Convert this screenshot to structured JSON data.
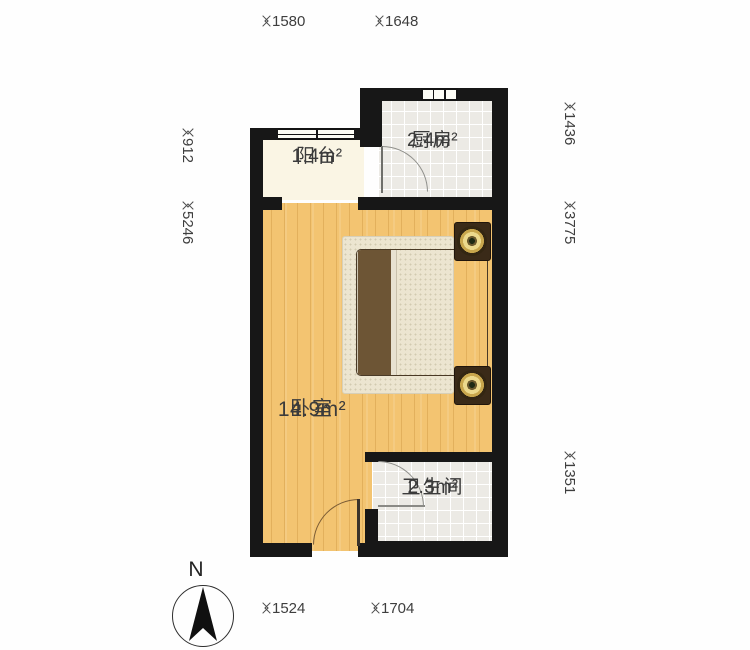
{
  "plan": {
    "rooms": [
      {
        "id": "balcony",
        "name": "阳台",
        "area": "1.4m²"
      },
      {
        "id": "kitchen",
        "name": "厨房",
        "area": "2.4m²"
      },
      {
        "id": "bedroom",
        "name": "卧室",
        "area": "14.9m²"
      },
      {
        "id": "bathroom",
        "name": "卫生间",
        "area": "2.3m²"
      }
    ],
    "dimensions": {
      "top": [
        "1580",
        "1648"
      ],
      "bottom": [
        "1524",
        "1704"
      ],
      "left": [
        "912",
        "5246"
      ],
      "right": [
        "1436",
        "3775",
        "1351"
      ]
    },
    "compass": {
      "label": "N"
    },
    "colors": {
      "wall": "#171717",
      "wood_floor": "#f3c471",
      "tile_floor": "#eceae5",
      "balcony_floor": "#faf5e4",
      "blanket_brown": "#6d5535",
      "bedding_cream": "#e8e2d1",
      "lamp_gold": "#c8a64c",
      "dimension_text": "#3e3e3e"
    }
  }
}
